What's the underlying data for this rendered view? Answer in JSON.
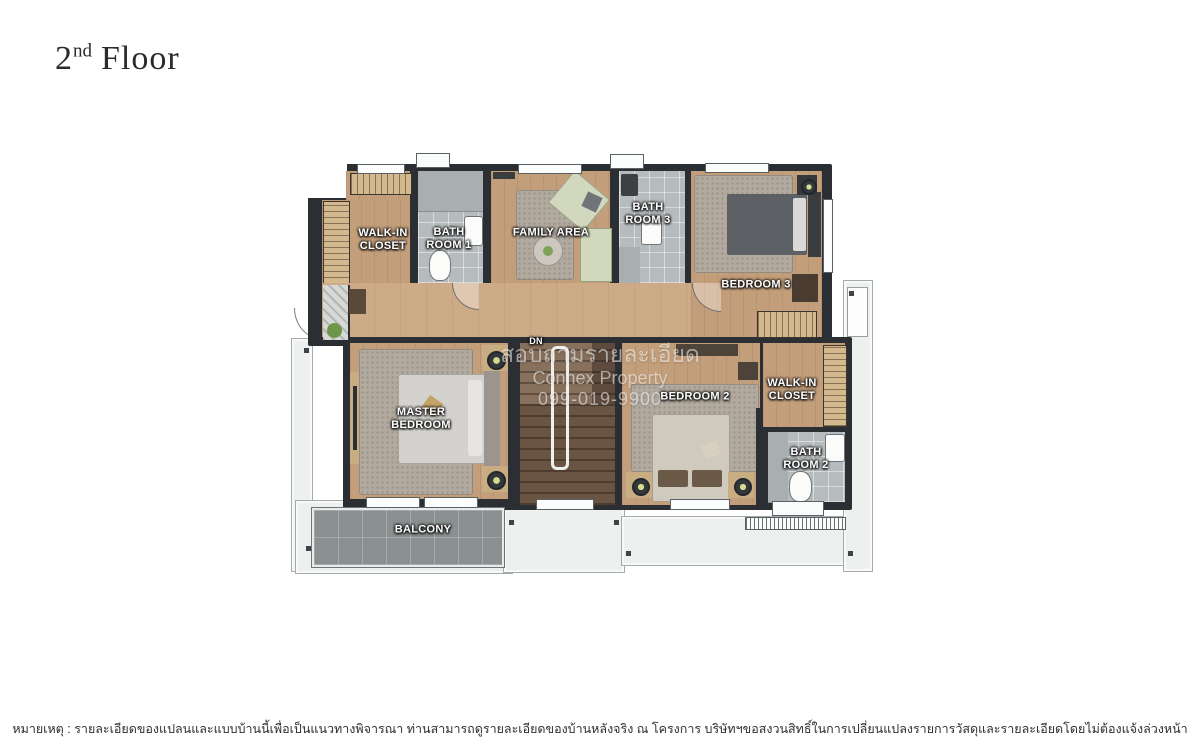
{
  "title": {
    "number": "2",
    "ordinal": "nd",
    "word": "Floor"
  },
  "plan": {
    "labels": {
      "walk_in_closet_1": "WALK-IN CLOSET",
      "bath_room_1": "BATH ROOM 1",
      "family_area": "FAMILY AREA",
      "bath_room_3": "BATH ROOM 3",
      "bedroom_3": "BEDROOM 3",
      "master_bedroom": "MASTER BEDROOM",
      "bedroom_2": "BEDROOM 2",
      "walk_in_closet_2": "WALK-IN CLOSET",
      "bath_room_2": "BATH ROOM 2",
      "balcony": "BALCONY",
      "stairs_down": "DN"
    },
    "palette": {
      "wall": "#2b2e32",
      "wood_floor": "#c39e7a",
      "hallway_floor": "#cdab87",
      "bathroom_floor": "#b6bbbd",
      "rug": "#b2aa9f",
      "stairs_wood": "#6a5443",
      "balcony_tiles": "#8a8f90",
      "deck": "#eef0f0",
      "furniture_green": "#d2d8bd",
      "room_label_text": "#ffffff"
    }
  },
  "watermark": {
    "line1": "สอบถามรายละเอียด",
    "line2": "Connex Property",
    "line3": "099-019-9900"
  },
  "footer": {
    "disclaimer": "หมายเหตุ : รายละเอียดของแปลนและแบบบ้านนี้เพื่อเป็นแนวทางพิจารณา ท่านสามารถดูรายละเอียดของบ้านหลังจริง ณ โครงการ บริษัทฯขอสงวนสิทธิ์ในการเปลี่ยนแปลงรายการวัสดุและรายละเอียดโดยไม่ต้องแจ้งล่วงหน้า"
  }
}
